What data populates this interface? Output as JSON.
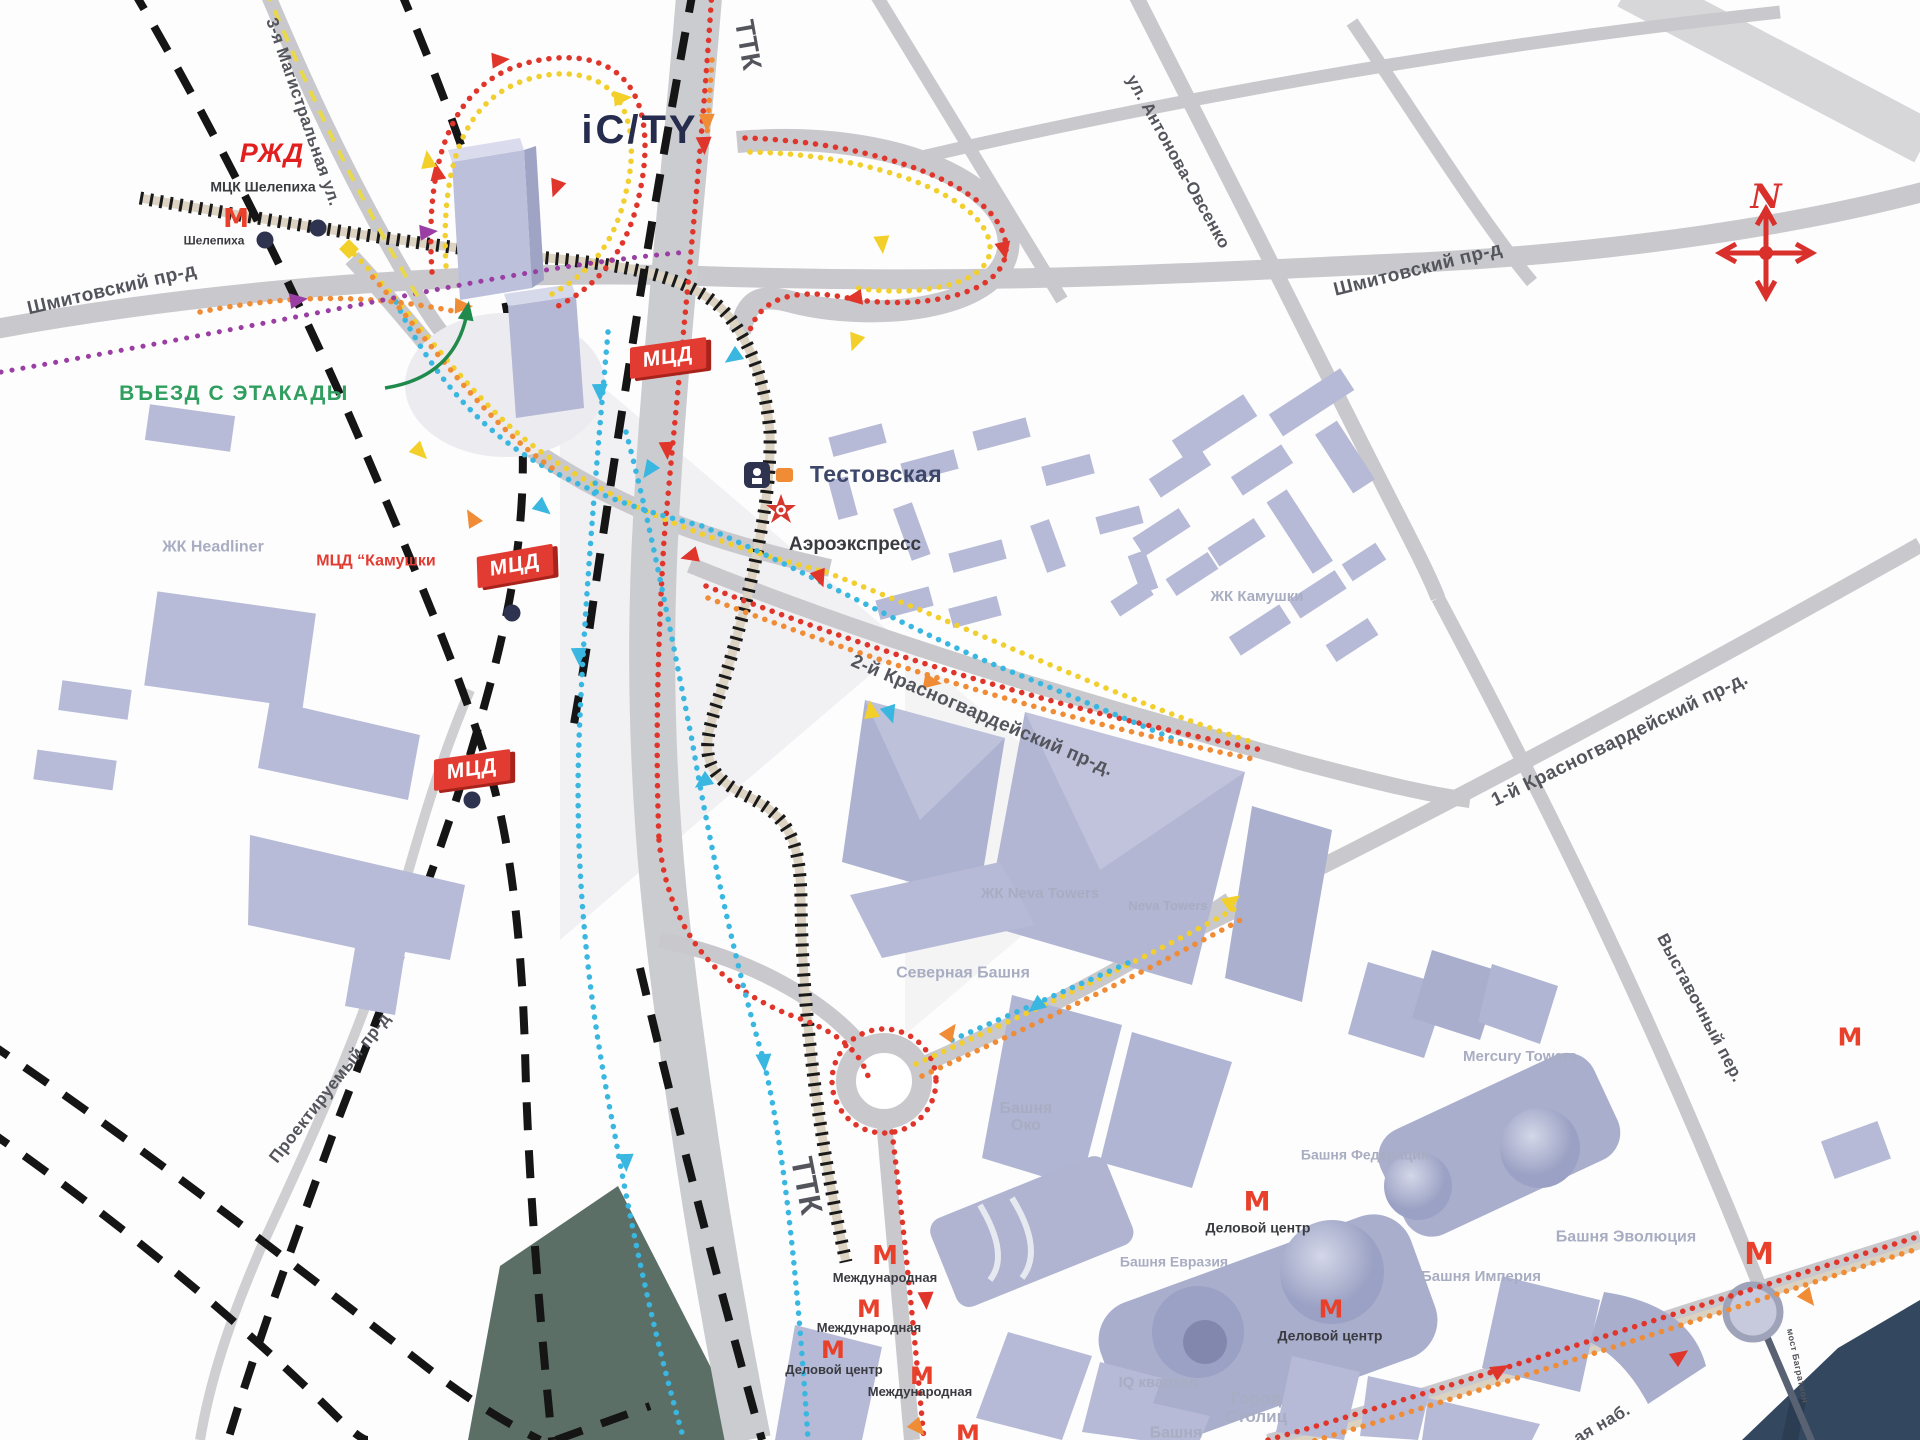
{
  "map": {
    "colors": {
      "road": "#c9c9cd",
      "building": "#b7bbd7",
      "building_dark": "#a9aecd",
      "water": "#33475f",
      "park": "#5c6f67",
      "route_red": "#e0352b",
      "route_yellow": "#f0cf2e",
      "route_cyan": "#39b7e0",
      "route_orange": "#ef8c35",
      "route_purple": "#9a3ea4",
      "badge_red": "#e23b32",
      "metro_red": "#e8402a",
      "green_note": "#2f9e5f",
      "rail_tick": "#1a1a1a",
      "dashed_line": "#151515"
    },
    "metro_glyph": "М",
    "badge_text": "МЦД",
    "labels": [
      {
        "name": "road-shmitovsky-west",
        "text": "Шмитовский пр-д",
        "x": 112,
        "y": 290,
        "rot": -13,
        "size": 19,
        "cls": "road"
      },
      {
        "name": "road-shmitovsky-east",
        "text": "Шмитовский пр-д",
        "x": 1418,
        "y": 270,
        "rot": -14,
        "size": 19,
        "cls": "road"
      },
      {
        "name": "road-magistralnaya",
        "text": "3-я Магистральная ул.",
        "x": 303,
        "y": 112,
        "rot": 71,
        "size": 17,
        "cls": "road"
      },
      {
        "name": "road-antonova",
        "text": "ул. Антонова-Овсенко",
        "x": 1178,
        "y": 162,
        "rot": 61,
        "size": 17,
        "cls": "road"
      },
      {
        "name": "road-ttk-north",
        "text": "ТТК",
        "x": 748,
        "y": 45,
        "rot": 80,
        "size": 27,
        "cls": "road"
      },
      {
        "name": "road-ttk-south",
        "text": "ТТК",
        "x": 806,
        "y": 1186,
        "rot": 79,
        "size": 31,
        "cls": "road"
      },
      {
        "name": "road-krasnogvardeisky-2",
        "text": "2-й Красногвардейский пр-д.",
        "x": 982,
        "y": 716,
        "rot": 23,
        "size": 19,
        "cls": "road"
      },
      {
        "name": "road-krasnogvardeisky-1",
        "text": "1-й Красногвардейский пр-д.",
        "x": 1620,
        "y": 740,
        "rot": -26,
        "size": 19,
        "cls": "road"
      },
      {
        "name": "road-vystavochny",
        "text": "Выставочный пер.",
        "x": 1700,
        "y": 1008,
        "rot": 62,
        "size": 17,
        "cls": "road"
      },
      {
        "name": "road-proektiruemy",
        "text": "Проектируемый пр-д",
        "x": 330,
        "y": 1088,
        "rot": -52,
        "size": 17,
        "cls": "road"
      },
      {
        "name": "road-naberezhnaya",
        "text": "ая наб.",
        "x": 1602,
        "y": 1424,
        "rot": -30,
        "size": 17,
        "cls": "road"
      },
      {
        "name": "road-most-bagration",
        "text": "мост Багратион",
        "x": 1797,
        "y": 1366,
        "rot": 78,
        "size": 9,
        "cls": "road"
      },
      {
        "name": "station-mck-shelepikha",
        "text": "МЦК Шелепиха",
        "x": 263,
        "y": 187,
        "rot": 0,
        "size": 14,
        "cls": "transit"
      },
      {
        "name": "station-shelepikha",
        "text": "Шелепиха",
        "x": 214,
        "y": 241,
        "rot": 0,
        "size": 12,
        "cls": "transit"
      },
      {
        "name": "station-aeroexpress",
        "text": "Аэроэкспресс",
        "x": 855,
        "y": 545,
        "rot": 0,
        "size": 19,
        "cls": "transit"
      },
      {
        "name": "station-delovoy-tsentr-1",
        "text": "Деловой центр",
        "x": 1258,
        "y": 1228,
        "rot": 0,
        "size": 14,
        "cls": "transit"
      },
      {
        "name": "station-delovoy-tsentr-2",
        "text": "Деловой центр",
        "x": 1330,
        "y": 1336,
        "rot": 0,
        "size": 14,
        "cls": "transit"
      },
      {
        "name": "station-delovoy-tsentr-3",
        "text": "Деловой центр",
        "x": 834,
        "y": 1370,
        "rot": 0,
        "size": 13,
        "cls": "transit"
      },
      {
        "name": "station-mezhdunarodnaya-1",
        "text": "Международная",
        "x": 885,
        "y": 1278,
        "rot": 0,
        "size": 13,
        "cls": "transit"
      },
      {
        "name": "station-mezhdunarodnaya-2",
        "text": "Международная",
        "x": 869,
        "y": 1328,
        "rot": 0,
        "size": 13,
        "cls": "transit"
      },
      {
        "name": "station-mezhdunarodnaya-3",
        "text": "Международная",
        "x": 920,
        "y": 1392,
        "rot": 0,
        "size": 13,
        "cls": "transit"
      },
      {
        "name": "area-headliner",
        "text": "ЖК Headliner",
        "x": 213,
        "y": 548,
        "rot": 0,
        "size": 16,
        "cls": "area"
      },
      {
        "name": "area-kamushki",
        "text": "ЖК Камушки",
        "x": 1257,
        "y": 597,
        "rot": 0,
        "size": 15,
        "cls": "area"
      },
      {
        "name": "area-neva-towers-zk",
        "text": "ЖК Neva Towers",
        "x": 1040,
        "y": 894,
        "rot": 0,
        "size": 15,
        "cls": "area"
      },
      {
        "name": "area-neva-towers",
        "text": "Neva Towers",
        "x": 1168,
        "y": 906,
        "rot": 0,
        "size": 13,
        "cls": "area"
      },
      {
        "name": "area-severnaya-bashnya",
        "text": "Северная Башня",
        "x": 963,
        "y": 974,
        "rot": 0,
        "size": 16,
        "cls": "area"
      },
      {
        "name": "area-bashnya-oko",
        "text": "Башня\nОко",
        "x": 1026,
        "y": 1118,
        "rot": 0,
        "size": 16,
        "cls": "area"
      },
      {
        "name": "area-mercury-towers",
        "text": "Mercury Towers",
        "x": 1520,
        "y": 1057,
        "rot": 0,
        "size": 15,
        "cls": "area"
      },
      {
        "name": "area-bashnya-federatsiya",
        "text": "Башня Федерация",
        "x": 1365,
        "y": 1155,
        "rot": 0,
        "size": 14,
        "cls": "area"
      },
      {
        "name": "area-bashnya-evrasia",
        "text": "Башня Евразия",
        "x": 1174,
        "y": 1262,
        "rot": 0,
        "size": 14,
        "cls": "area"
      },
      {
        "name": "area-iq-kvartal",
        "text": "IQ квартал",
        "x": 1158,
        "y": 1383,
        "rot": 0,
        "size": 15,
        "cls": "area"
      },
      {
        "name": "area-gorod-stolits",
        "text": "Город\nСтолиц",
        "x": 1256,
        "y": 1408,
        "rot": 0,
        "size": 17,
        "cls": "area"
      },
      {
        "name": "area-bashnya-partial",
        "text": "Башня",
        "x": 1176,
        "y": 1434,
        "rot": 0,
        "size": 16,
        "cls": "area"
      },
      {
        "name": "area-bashnya-imperia",
        "text": "Башня Империя",
        "x": 1481,
        "y": 1277,
        "rot": 0,
        "size": 15,
        "cls": "area"
      },
      {
        "name": "area-bashnya-evolution",
        "text": "Башня Эволюция",
        "x": 1626,
        "y": 1238,
        "rot": 0,
        "size": 16,
        "cls": "area"
      },
      {
        "name": "note-mcd-kamushki",
        "text": "МЦД “Камушки",
        "x": 376,
        "y": 562,
        "rot": 0,
        "size": 16,
        "cls": "red"
      },
      {
        "name": "note-entrance",
        "text": "ВЪЕЗД С ЭТАКАДЫ",
        "x": 234,
        "y": 394,
        "rot": 0,
        "size": 21,
        "cls": "green"
      },
      {
        "name": "station-testovskaya",
        "text": "Тестовская",
        "x": 876,
        "y": 474,
        "rot": 0,
        "size": 23,
        "cls": "navy"
      },
      {
        "name": "logo-icity",
        "text": "iC/TY",
        "x": 640,
        "y": 130,
        "rot": 0,
        "size": 40,
        "cls": "logo-icity"
      },
      {
        "name": "logo-rzd",
        "text": "РЖД",
        "x": 272,
        "y": 153,
        "rot": 0,
        "size": 27,
        "cls": "logo-rzd"
      },
      {
        "name": "compass-n-letter",
        "text": "N",
        "x": 1766,
        "y": 198,
        "rot": 0,
        "size": 34,
        "cls": "compass-n"
      }
    ],
    "badges": [
      {
        "name": "badge-mcd-testovskaya",
        "x": 668,
        "y": 358,
        "rot": -8
      },
      {
        "name": "badge-mcd-kamushki",
        "x": 515,
        "y": 566,
        "rot": -10
      },
      {
        "name": "badge-mcd-south",
        "x": 472,
        "y": 770,
        "rot": -8
      }
    ],
    "metro_icons": [
      {
        "name": "metro-icon-shelepikha",
        "x": 236,
        "y": 219,
        "size": 26
      },
      {
        "name": "metro-icon-delovoy-1",
        "x": 1257,
        "y": 1202,
        "size": 27
      },
      {
        "name": "metro-icon-delovoy-2",
        "x": 1331,
        "y": 1309,
        "size": 25
      },
      {
        "name": "metro-icon-mezhdunarodnaya-1",
        "x": 885,
        "y": 1256,
        "size": 26
      },
      {
        "name": "metro-icon-mezhdunarodnaya-2",
        "x": 869,
        "y": 1309,
        "size": 24
      },
      {
        "name": "metro-icon-delovoy-3",
        "x": 833,
        "y": 1350,
        "size": 24
      },
      {
        "name": "metro-icon-mezhdunarodnaya-3",
        "x": 922,
        "y": 1376,
        "size": 24
      },
      {
        "name": "metro-icon-evolution",
        "x": 1759,
        "y": 1255,
        "size": 30
      },
      {
        "name": "metro-icon-east-edge",
        "x": 1850,
        "y": 1037,
        "size": 25
      },
      {
        "name": "metro-icon-bottom",
        "x": 968,
        "y": 1434,
        "size": 24
      }
    ],
    "station_dots": [
      {
        "x": 265,
        "y": 240
      },
      {
        "x": 318,
        "y": 228
      },
      {
        "x": 512,
        "y": 613
      },
      {
        "x": 472,
        "y": 800
      }
    ]
  }
}
